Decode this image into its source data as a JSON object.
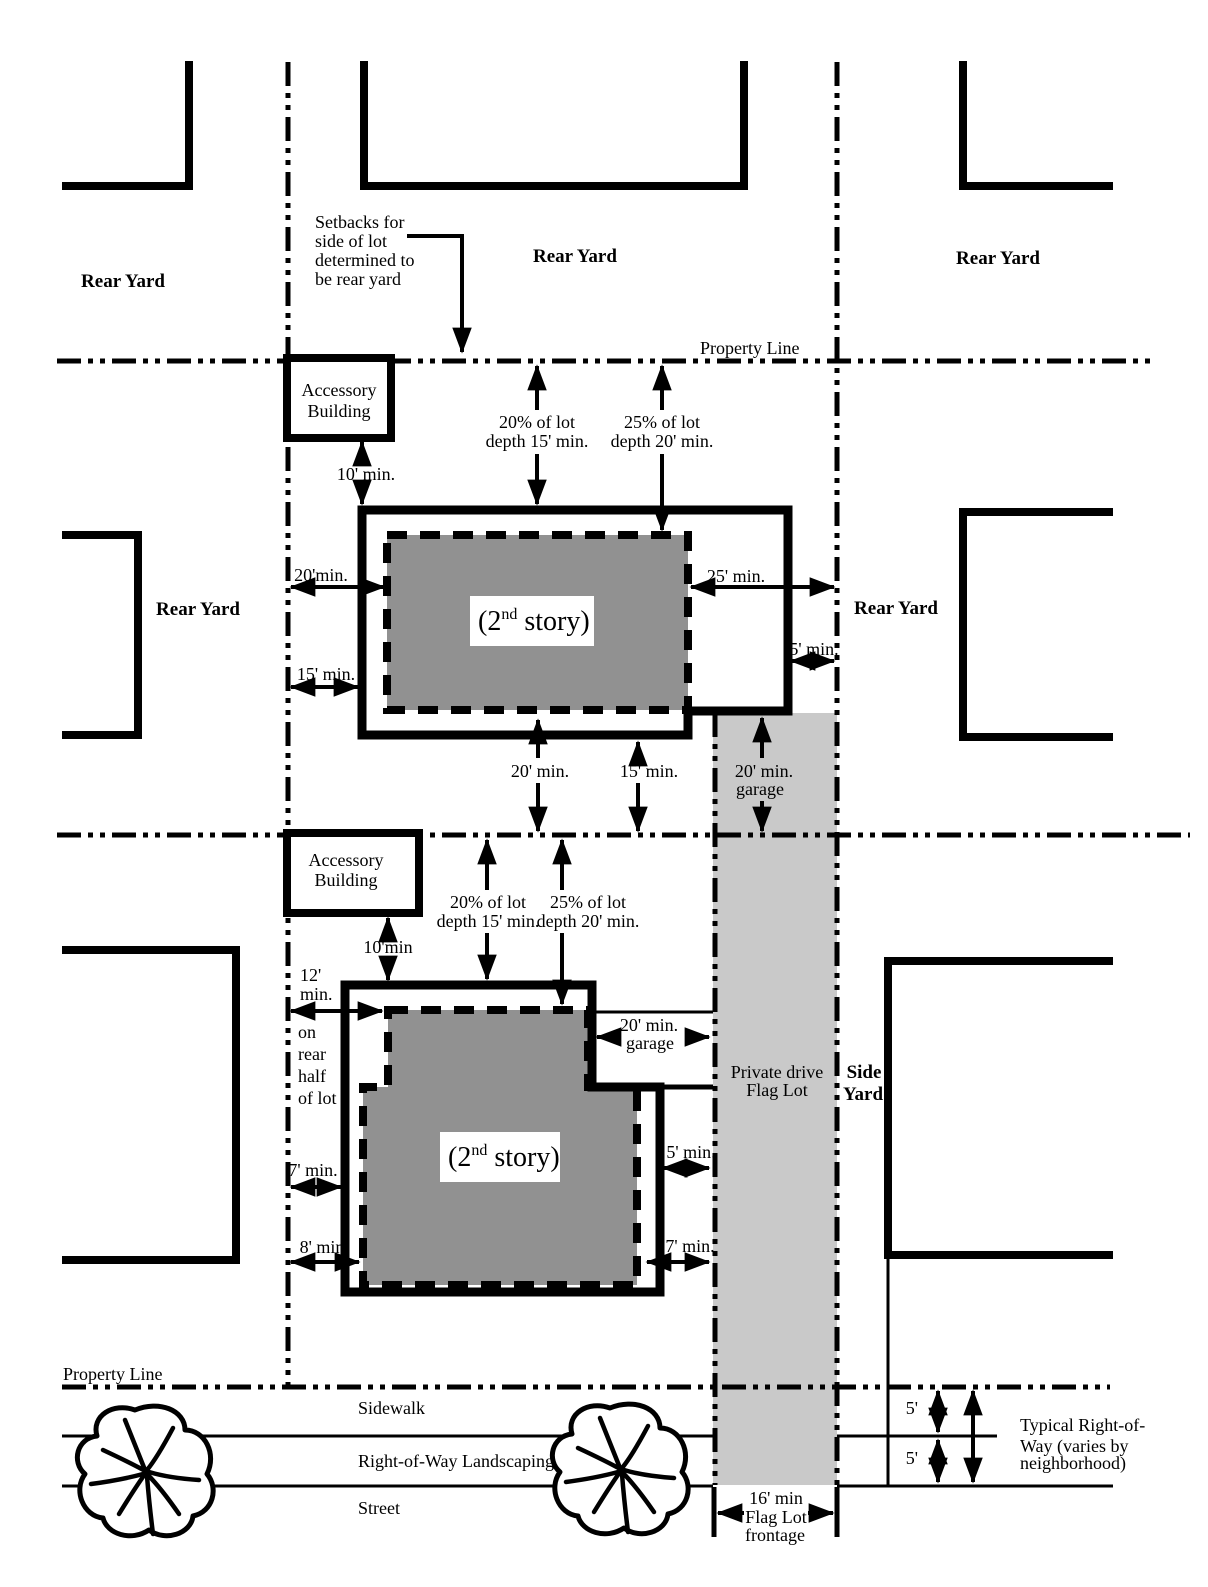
{
  "colors": {
    "second_story_fill": "#919191",
    "flag_lot_drive_fill": "#c9c9c9",
    "line_color": "#000000"
  },
  "labels": {
    "rear_yard": "Rear Yard",
    "property_line": "Property Line",
    "sidewalk": "Sidewalk",
    "right_of_way_landscaping": "Right-of-Way Landscaping",
    "street": "Street",
    "accessory": {
      "line1": "Accessory",
      "line2": "Building"
    },
    "setbacks_note": {
      "line1": "Setbacks for",
      "line2": "side  of lot",
      "line3": "determined to",
      "line4": "be rear yard"
    },
    "second_story": {
      "open": "(2",
      "sup": "nd",
      "rest": " story)"
    },
    "dims": {
      "d10": "10' min.",
      "d10_nospace": "10'min",
      "d20_nospace": "20'min.",
      "d15": "15' min.",
      "d25": "25' min.",
      "d5": "5' min.",
      "d20": "20' min.",
      "d7": "7' min.",
      "d8": "8' min",
      "d12_line1": "12'",
      "d12_line2": "min.",
      "five": "5'",
      "garage_line2": "garage",
      "pct20_line1": "20% of lot",
      "pct20_line2": "depth 15' min.",
      "pct25_line1": "25% of lot",
      "pct25_line2": "depth 20' min.",
      "on_rear": {
        "l1": "on",
        "l2": "rear",
        "l3": "half",
        "l4": "of lot"
      }
    },
    "flag_lot": {
      "private_drive_l1": "Private drive",
      "private_drive_l2": "Flag Lot",
      "frontage_l1": "16' min",
      "frontage_l2": "Flag Lot",
      "frontage_l3": "frontage"
    },
    "side_yard": {
      "l1": "Side",
      "l2": "Yard"
    },
    "typical_row": {
      "l1": "Typical Right-of-",
      "l2": "Way (varies by",
      "l3": "neighborhood)"
    }
  }
}
